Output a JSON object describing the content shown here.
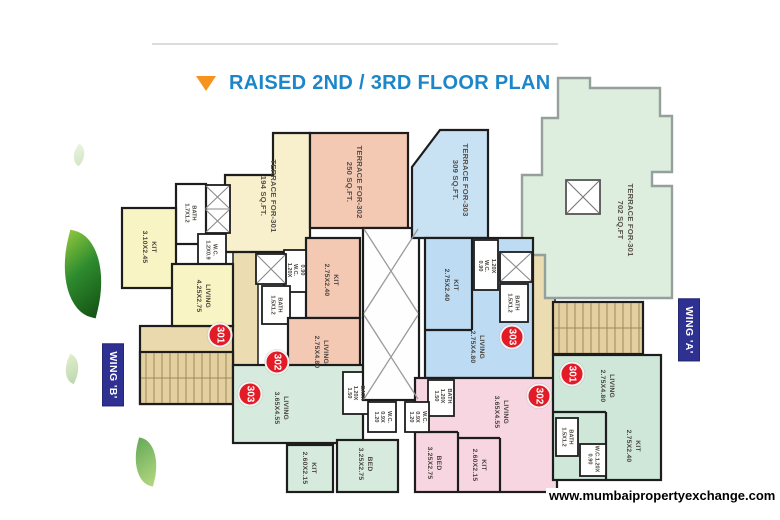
{
  "title": "RAISED 2ND / 3RD FLOOR PLAN",
  "watermark": "www.mumbaipropertyexchange.com",
  "icons": {
    "title_marker": "triangle-down-icon",
    "lift": "crossed-box-icon",
    "shaft": "crossed-box-icon"
  },
  "colors": {
    "title_blue": "#1d86c8",
    "marker_orange": "#f6921e",
    "wing_badge_navy": "#2e3192",
    "unit_badge_red": "#e21b26",
    "wall_black": "#1d1d1d"
  },
  "wing_b": {
    "name": "WING 'B'",
    "badge_301": "301",
    "badge_302": "302",
    "badge_303": "303",
    "terrace_301": "TERRACE FOR-301\n194 SQ.FT.",
    "terrace_302": "TERRACE FOR-302\n250 SQ.FT.",
    "bath_301": "BATH\n1.7X1.2",
    "kit_301": "KIT\n3.10X2.45",
    "wc_301": "W.C.\n1.2X0.9",
    "living_301": "LIVING\n4.25X2.75",
    "kit_302": "KIT\n2.75X2.40",
    "wc_302": "0.90\nW.C.\n1.20X",
    "bath_302": "BATH\n1.5X1.2",
    "living_302": "LIVING\n2.75X4.80",
    "living_303": "LIVING\n3.65X4.55",
    "bath_303": "BATH\n1.20X\n1.50",
    "wc_303": "W.C.\n0.9X\n1.20",
    "kit_303": "KIT\n2.60X2.15",
    "bed_303": "BED\n3.25X2.75"
  },
  "wing_a": {
    "name": "WING 'A'",
    "badge_301": "301",
    "badge_302": "302",
    "badge_303": "303",
    "terrace_301": "TERRACE FOR-301\n702 SQ.FT",
    "terrace_303": "TERRACE FOR-303\n309 SQ.FT.",
    "kit_303": "KIT\n2.75X2.40",
    "wc_303": "1.20X\nW.C.\n0.90",
    "bath_303": "BATH\n1.5X1.2",
    "living_303": "LIVING\n2.75X4.80",
    "living_301": "LIVING\n2.75X4.80",
    "bath_301": "BATH\n1.5X1.2",
    "wc_301": "W.C.1.20X\n0.90",
    "kit_301": "KIT\n2.75X2.40",
    "living_302": "LIVING\n3.65X4.55",
    "bath_302": "BATH\n1.20X\n1.50",
    "wc_302": "W.C.\n0.9X\n1.20",
    "bed_302": "BED\n3.25X2.75",
    "kit_302": "KIT\n2.60X2.15"
  }
}
